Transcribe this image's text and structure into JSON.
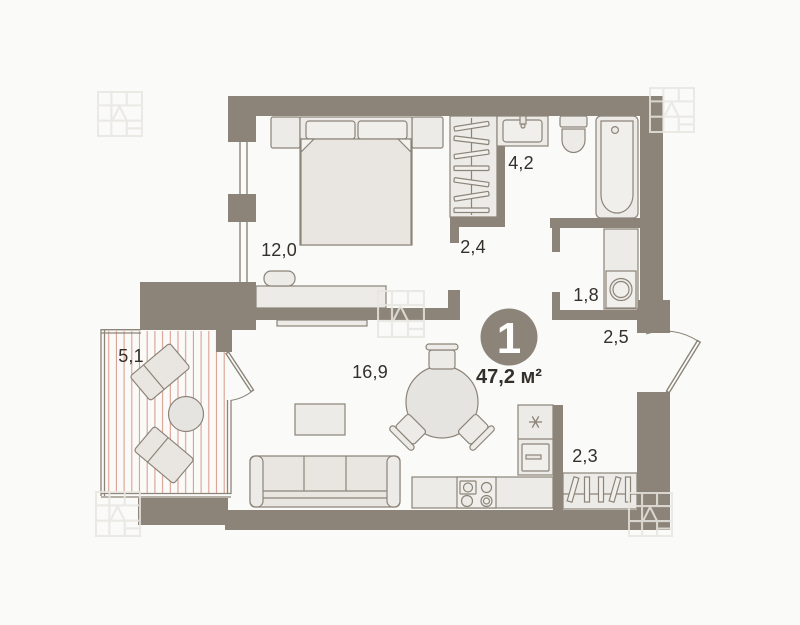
{
  "plan": {
    "badge": {
      "number": "1",
      "area": "47,2 м²"
    },
    "rooms": {
      "bedroom": "12,0",
      "wardrobe": "2,4",
      "bathroom": "4,2",
      "laundry": "1,8",
      "hallway": "2,5",
      "living_room": "16,9",
      "balcony": "5,1",
      "closet": "2,3"
    },
    "fixtures": [
      "bed",
      "nightstand",
      "dresser",
      "pouf",
      "tv",
      "hanger-rail",
      "sink",
      "toilet",
      "bathtub",
      "washing-machine",
      "sofa",
      "coffee-table",
      "dining-table",
      "chair",
      "kitchen-counter",
      "stove",
      "fridge",
      "lounge-chair",
      "balcony-table"
    ],
    "colors": {
      "wall": "#8C8478",
      "furniture_fill": "#E9E6E2",
      "furniture_fill_light": "#EDEBE7",
      "background": "#FAFAF8",
      "balcony_stripe": "#DB9E91",
      "label_text": "#332F2A",
      "badge_fill": "#8C8478",
      "badge_text": "#FFFFFF"
    }
  }
}
